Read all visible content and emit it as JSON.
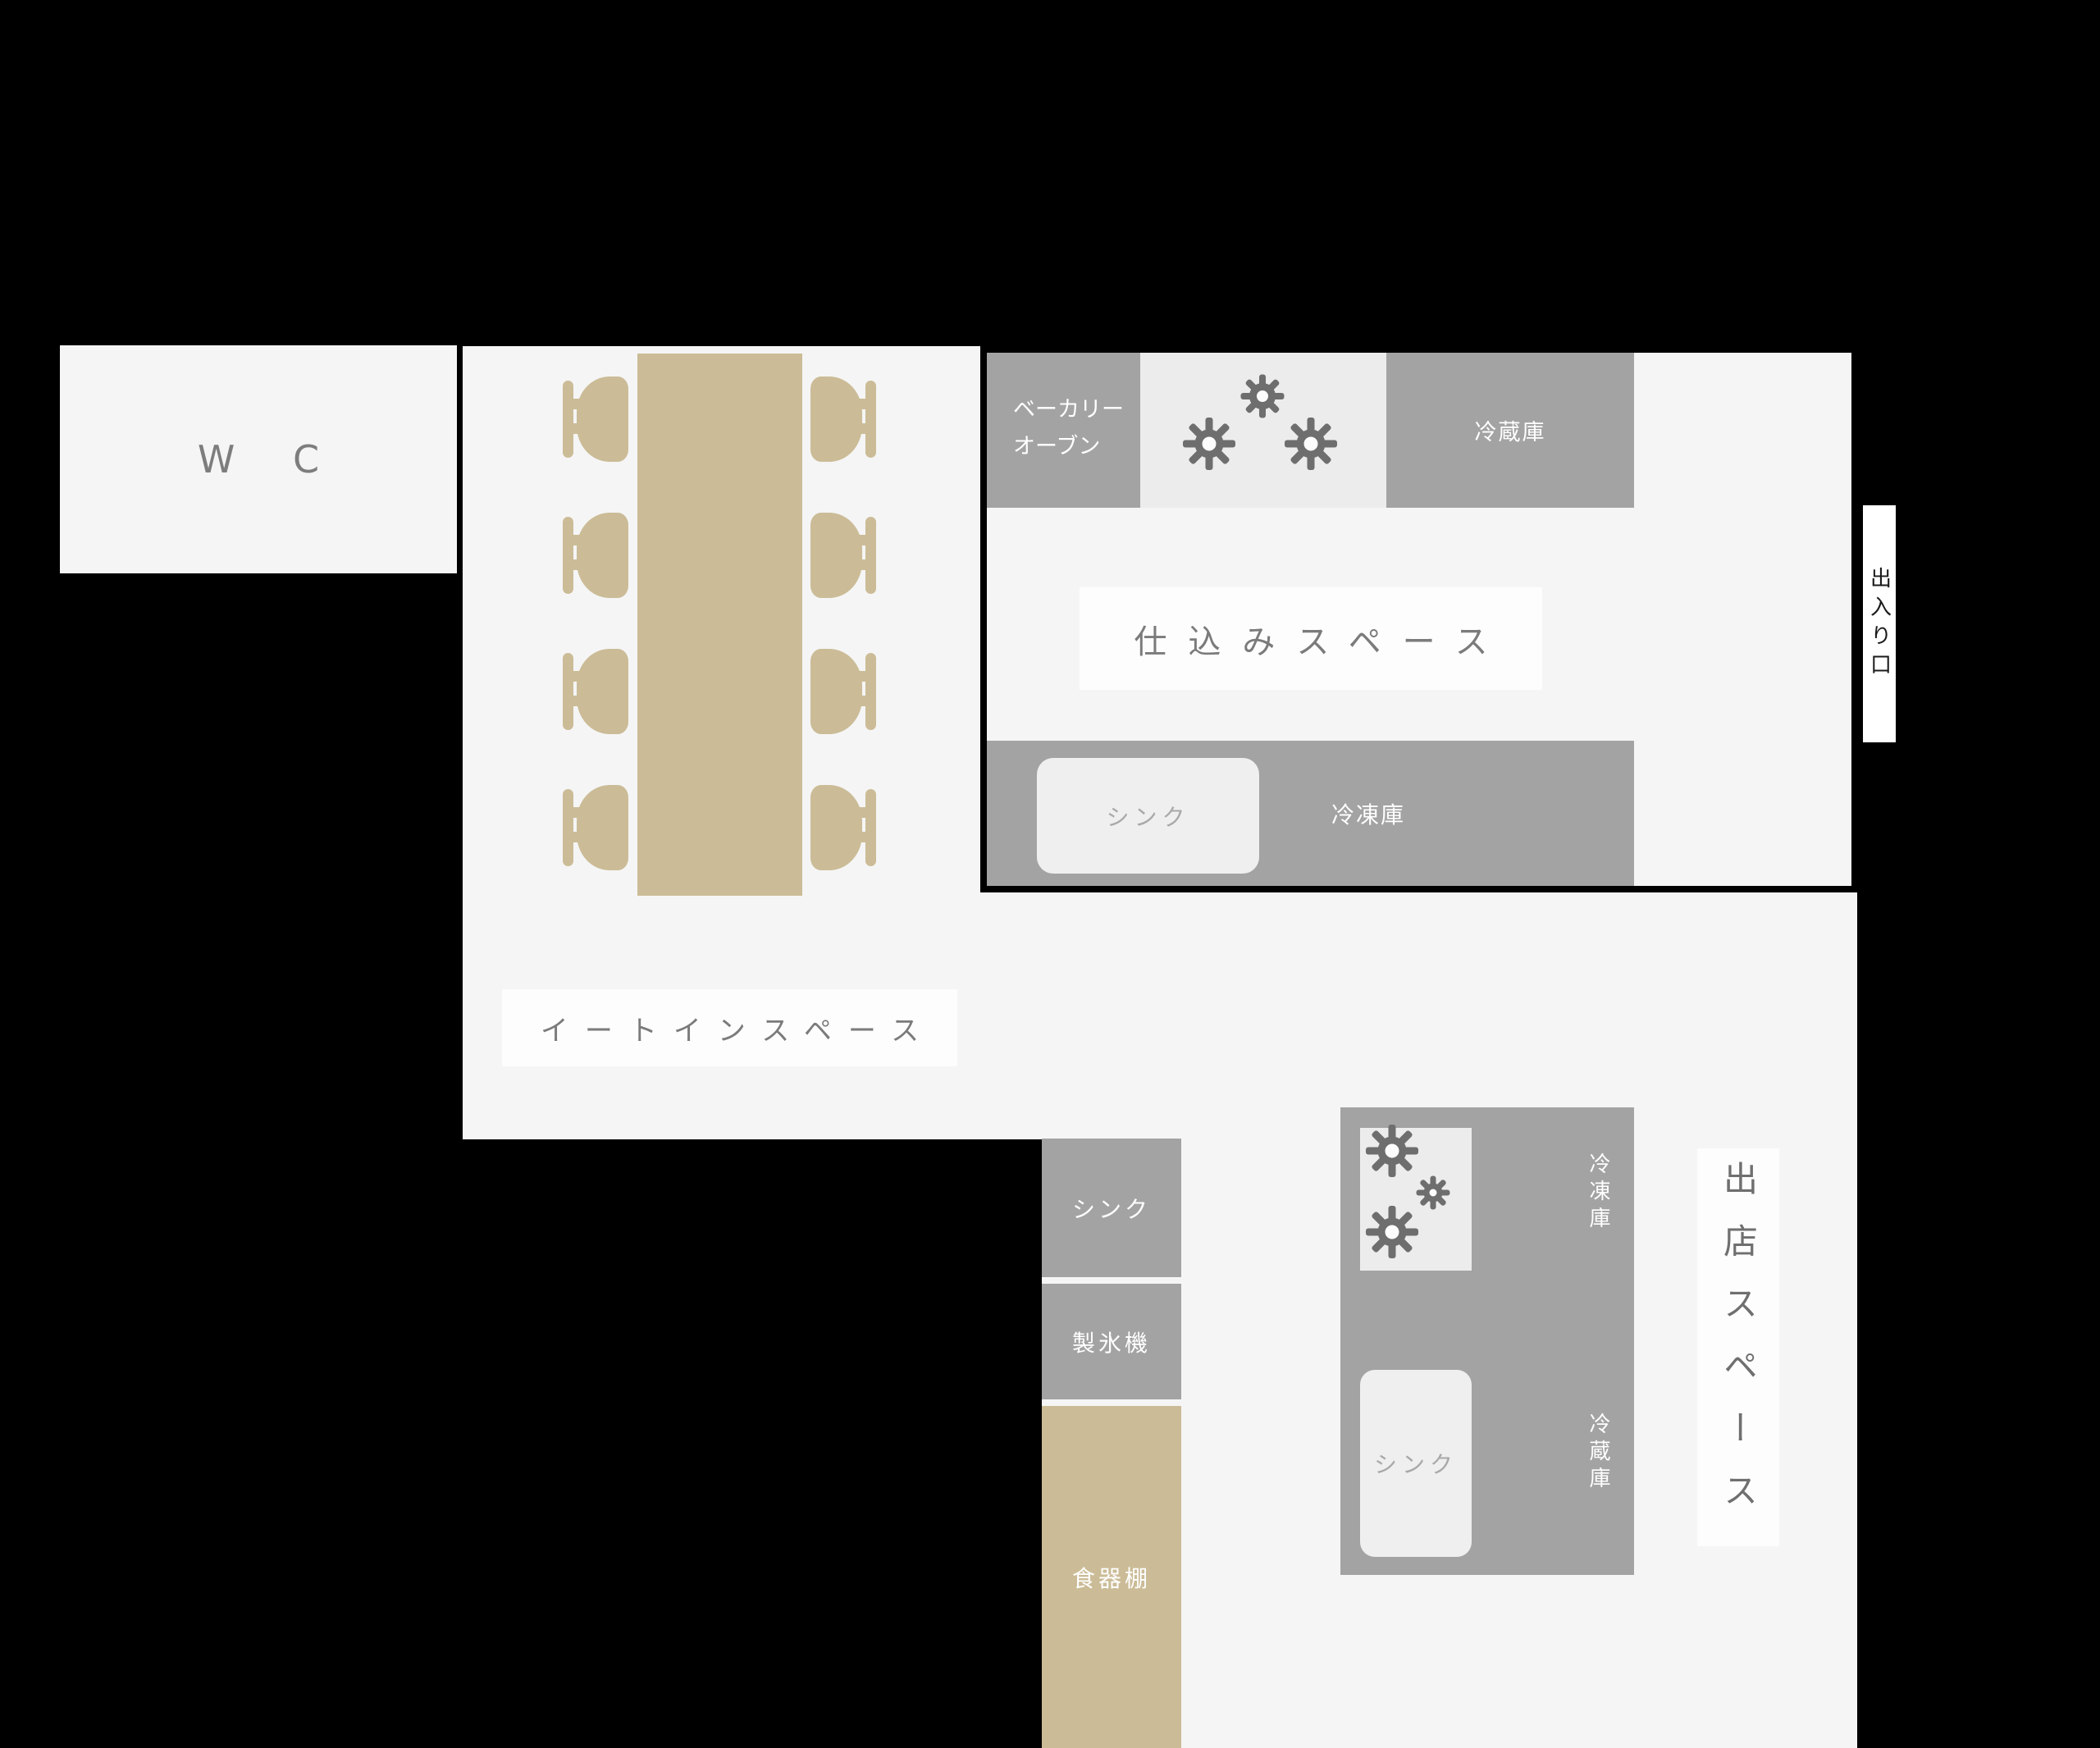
{
  "palette": {
    "background": "#000000",
    "floor": "#f5f5f5",
    "appliance_gray": "#a3a3a3",
    "wood_tan": "#cbbc97",
    "light_panel": "#ececec",
    "label_box": "#fdfdfd",
    "label_text": "#7b7b7b",
    "white_text": "#ffffff",
    "muted_text": "#a9a9a9",
    "burner_stroke": "#6e6e6e"
  },
  "rooms": {
    "wc": {
      "label": "W C"
    },
    "eat_in": {
      "label": "イートインスペース"
    },
    "prep": {
      "label": "仕込みスペース",
      "oven_line1": "ベーカリー",
      "oven_line2": "オーブン",
      "fridge_label": "冷蔵庫",
      "sink_label": "シンク",
      "freezer_label": "冷凍庫"
    },
    "entrance": {
      "label": "出入り口"
    },
    "service_column": {
      "sink_label": "シンク",
      "ice_maker_label": "製氷機",
      "cupboard_label": "食器棚"
    },
    "shop": {
      "label": "出店スペース",
      "freezer_label": "冷凍庫",
      "fridge_label": "冷蔵庫",
      "sink_label": "シンク"
    }
  }
}
